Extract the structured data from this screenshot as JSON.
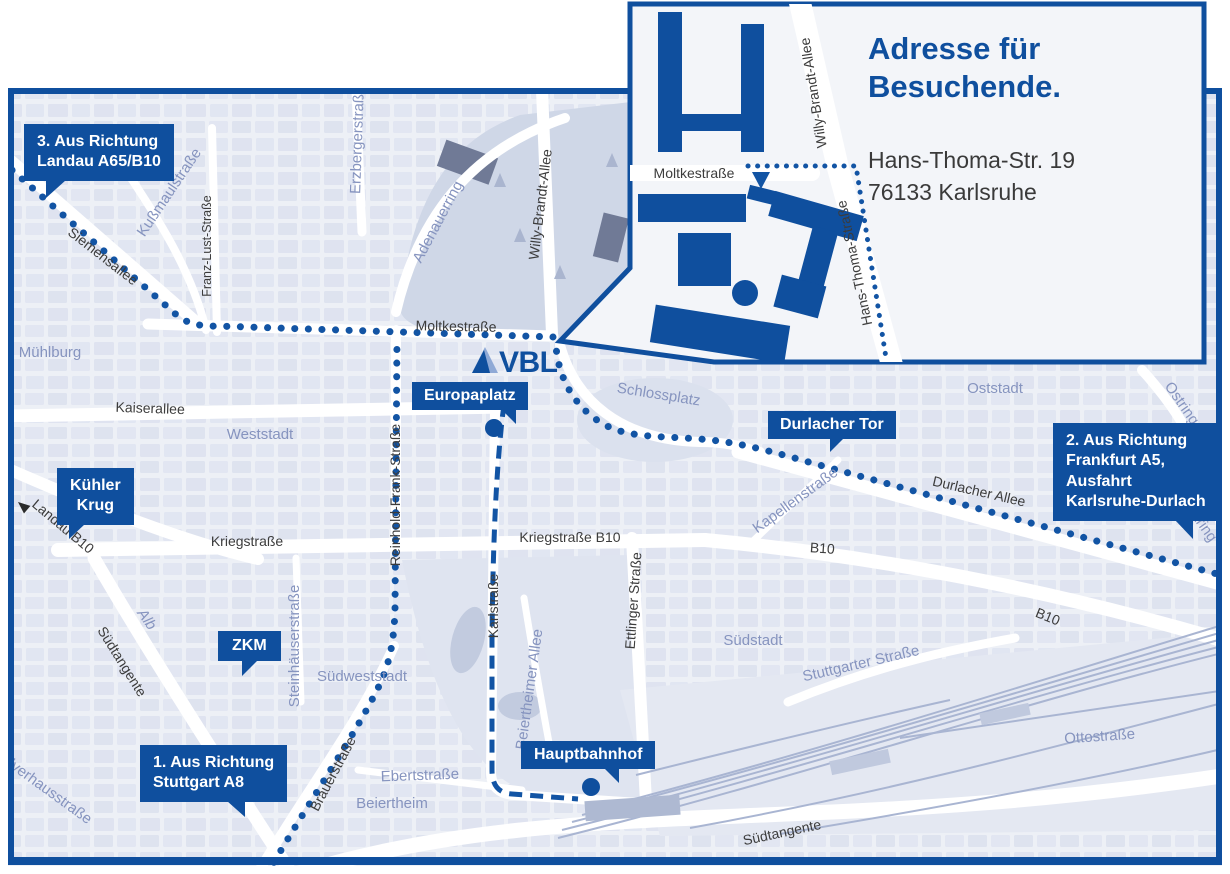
{
  "colors": {
    "brand_blue": "#0f4f9e",
    "route_blue": "#1254a4",
    "map_bg": "#edf0f6",
    "block_fill": "#dde2ef",
    "park_fill": "#cfd7e7",
    "railway_line": "#a9b5d2",
    "district_label": "#8694bf",
    "street_label": "#3c3c3c",
    "address_text": "#3a3a3a"
  },
  "logo": {
    "text": "VBL"
  },
  "inset": {
    "title_line1": "Adresse für",
    "title_line2": "Besuchende.",
    "address_line1": "Hans-Thoma-Str. 19",
    "address_line2": "76133 Karlsruhe",
    "street_labels": {
      "moltkestrasse": "Moltkestraße",
      "willy_brandt_allee": "Willy-Brandt-Allee",
      "hans_thoma_strasse": "Hans-Thoma-Straße"
    }
  },
  "callouts": {
    "landau": {
      "lines": [
        "3. Aus Richtung",
        "Landau A65/B10"
      ]
    },
    "kuehler_krug": {
      "lines": [
        "Kühler",
        "Krug"
      ]
    },
    "zkm": {
      "lines": [
        "ZKM"
      ]
    },
    "stuttgart": {
      "lines": [
        "1. Aus Richtung",
        "Stuttgart A8"
      ]
    },
    "europaplatz": {
      "lines": [
        "Europaplatz"
      ]
    },
    "durlacher_tor": {
      "lines": [
        "Durlacher Tor"
      ]
    },
    "frankfurt": {
      "lines": [
        "2. Aus Richtung",
        "Frankfurt A5,",
        "Ausfahrt",
        "Karlsruhe-Durlach"
      ]
    },
    "hauptbahnhof": {
      "lines": [
        "Hauptbahnhof"
      ]
    }
  },
  "map_labels": {
    "siemensallee": "Siemensallee",
    "kussmaulstrasse": "Kußmaulstraße",
    "franz_lust_strasse": "Franz-Lust-Straße",
    "erzbergerstrasse": "Erzbergerstraße",
    "adenauerring": "Adenauerring",
    "willy_brandt_allee": "Willy-Brandt-Allee",
    "moltkestrasse": "Moltkestraße",
    "muehlburg": "Mühlburg",
    "kaiserallee": "Kaiserallee",
    "weststadt": "Weststadt",
    "reinhold_frank_strasse": "Reinhold-Frank-Straße",
    "kriegstrasse": "Kriegstraße",
    "kriegstrasse_b10": "Kriegstraße B10",
    "karlstrasse": "Karlstraße",
    "ettlinger_strasse": "Ettlinger Straße",
    "schlossplatz": "Schlossplatz",
    "durlacher_allee": "Durlacher Allee",
    "kapellenstrasse": "Kapellenstraße",
    "b10_mid": "B10",
    "b10_southeast": "B10",
    "landau_b10": "Landau B10",
    "suedtangente_west": "Südtangente",
    "suedtangente_bottom": "Südtangente",
    "alb": "Alb",
    "steinhaeuserstrasse": "Steinhäuserstraße",
    "suedweststadt": "Südweststadt",
    "brauerstrasse": "Brauerstraße",
    "ebertstrasse": "Ebertstraße",
    "beiertheim": "Beiertheim",
    "beiertheimer_allee": "Beiertheimer Allee",
    "pulverhausstrasse": "Pulverhausstraße",
    "oststadt": "Oststadt",
    "ostring_north": "Ostring",
    "ostring_south": "Ostring",
    "suedstadt": "Südstadt",
    "stuttgarter_strasse": "Stuttgarter Straße",
    "ottostrasse": "Ottostraße"
  }
}
